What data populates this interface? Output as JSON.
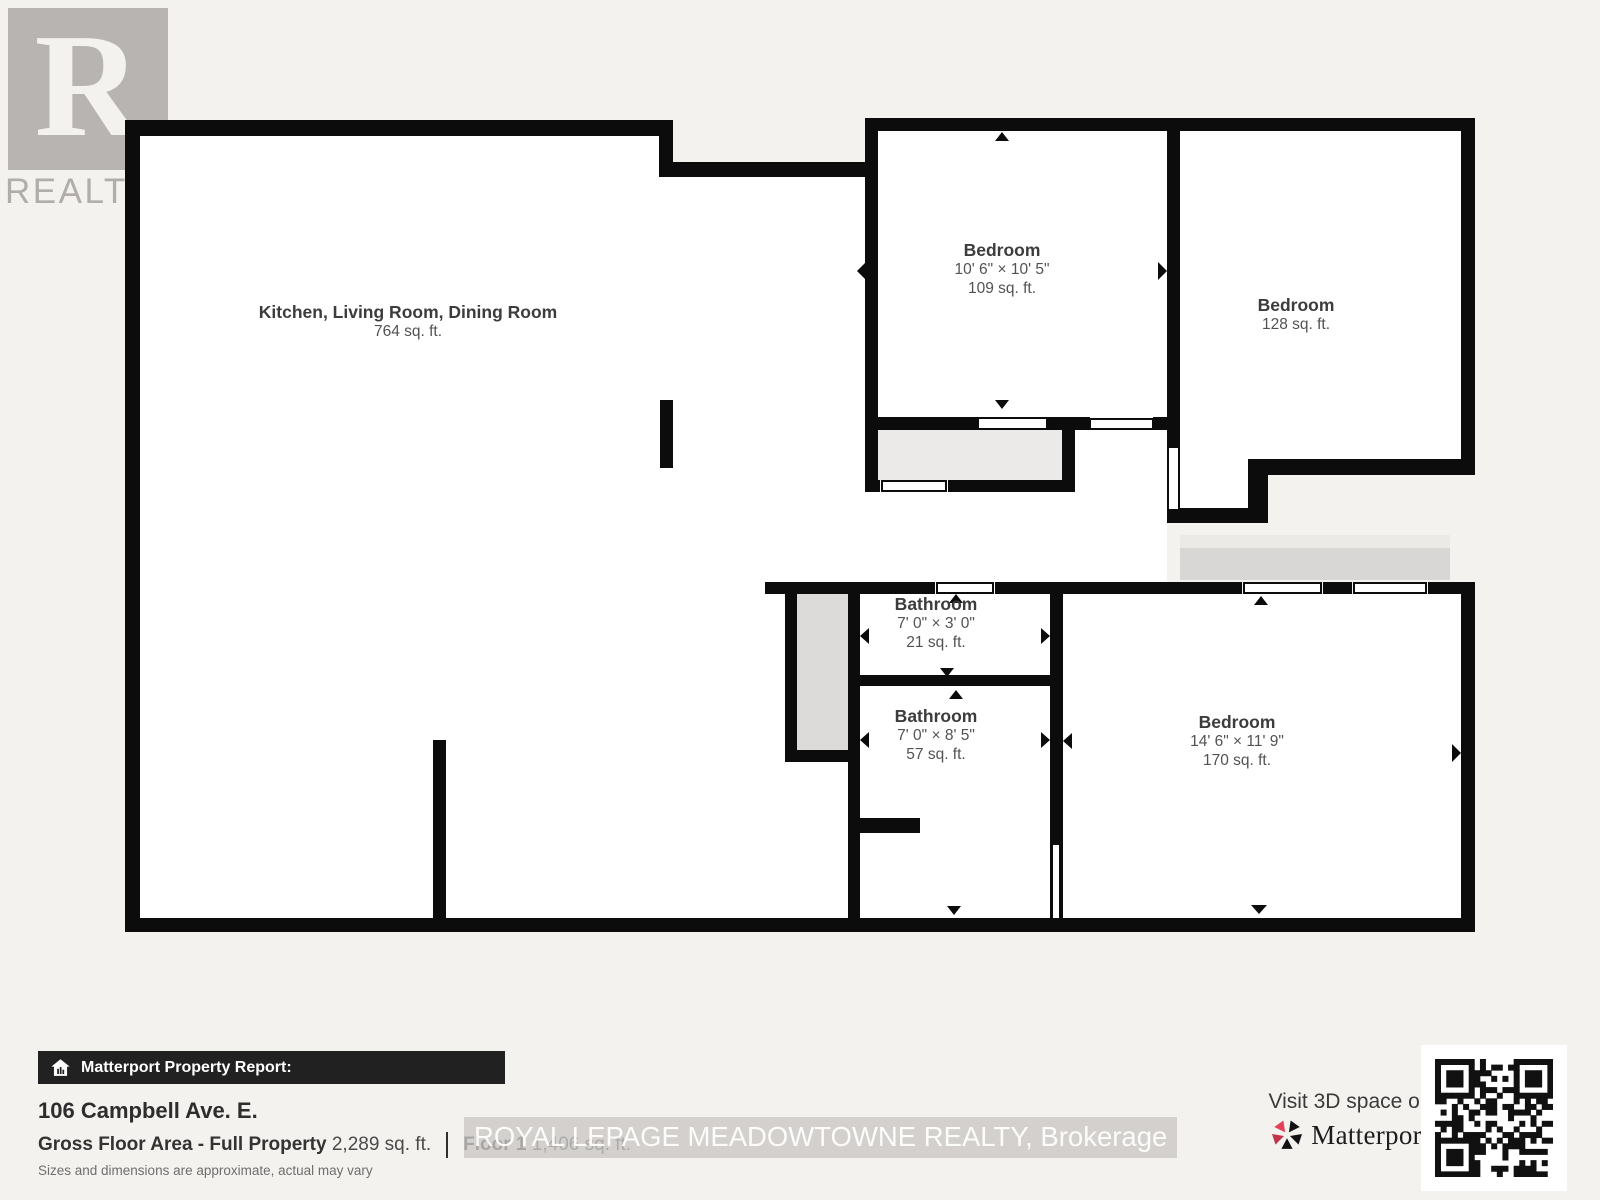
{
  "branding": {
    "realtor_logo_letter": "R",
    "realtor_logo_text": "REALTOR®"
  },
  "floor_plan": {
    "rooms": [
      {
        "name": "Kitchen, Living Room, Dining Room",
        "dimensions": "",
        "area": "764 sq. ft."
      },
      {
        "name": "Bedroom",
        "dimensions": "10' 6\" × 10' 5\"",
        "area": "109 sq. ft."
      },
      {
        "name": "Bedroom",
        "dimensions": "",
        "area": "128 sq. ft."
      },
      {
        "name": "Bathroom",
        "dimensions": "7' 0\" × 3' 0\"",
        "area": "21 sq. ft."
      },
      {
        "name": "Bathroom",
        "dimensions": "7' 0\" × 8' 5\"",
        "area": "57 sq. ft."
      },
      {
        "name": "Bedroom",
        "dimensions": "14' 6\" × 11' 9\"",
        "area": "170 sq. ft."
      }
    ]
  },
  "report": {
    "bar_title": "Matterport Property Report:",
    "address": "106 Campbell Ave. E.",
    "gross_label": "Gross Floor Area - Full Property",
    "gross_value": "2,289 sq. ft.",
    "floor_label": "Floor 1",
    "floor_value": "1,406 sq. ft.",
    "disclaimer": "Sizes and dimensions are approximate, actual may vary"
  },
  "watermark": {
    "text": "ROYAL LEPAGE MEADOWTOWNE REALTY, Brokerage"
  },
  "matterport": {
    "visit_text": "Visit 3D space on",
    "brand": "Matterport"
  },
  "colors": {
    "background": "#f4f2ef",
    "wall": "#0c0c0c",
    "room_fill": "#ffffff",
    "closet_fill_light": "#ebeae8",
    "closet_fill": "#dcdbd9",
    "deck_fill": "#d9d7d5",
    "brand_red": "#e64158",
    "bar_background": "#212121"
  }
}
